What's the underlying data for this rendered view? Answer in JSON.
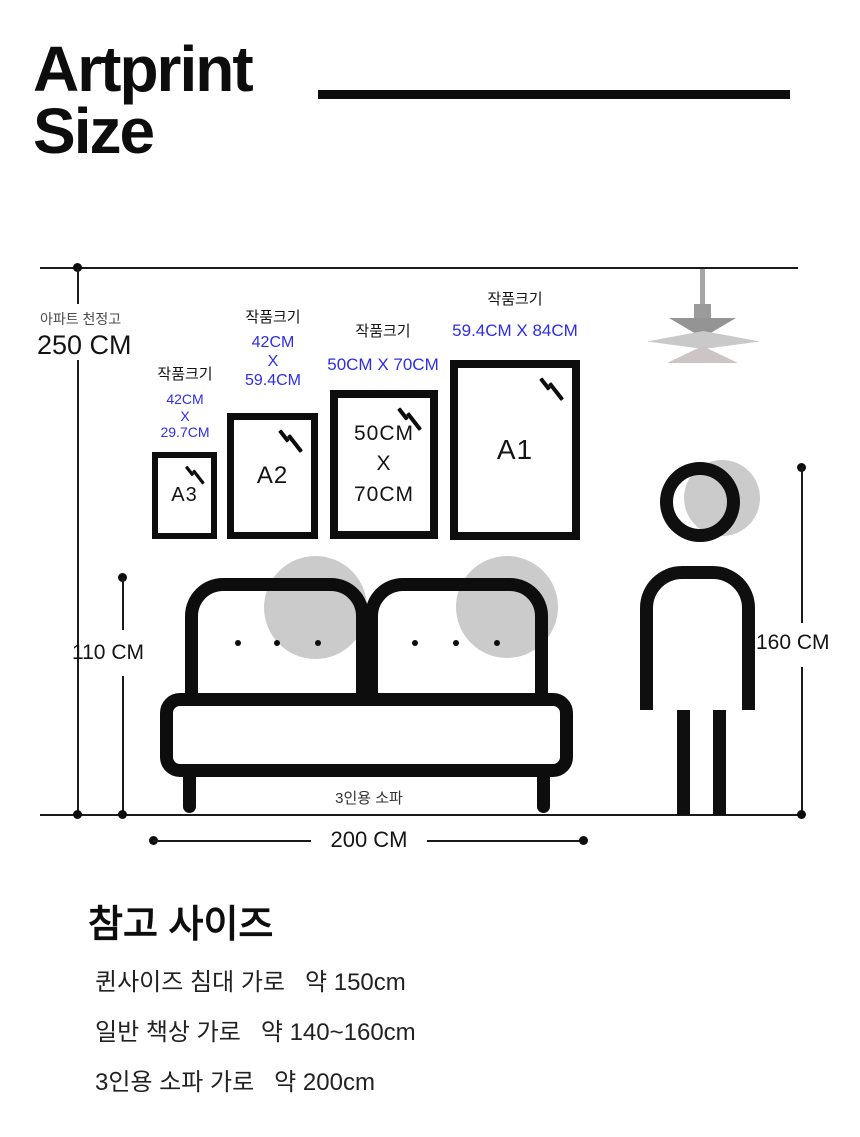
{
  "title": {
    "text": "Artprint\nSize"
  },
  "colors": {
    "accent_blue": "#2e2ee9",
    "ink": "#0d0d0d",
    "shape_gray": "#cbcbcb"
  },
  "icons": [
    "pendant-lamp-icon",
    "glass-glare-icon",
    "sofa-figure",
    "person-figure"
  ],
  "diagram": {
    "ceiling": {
      "caption": "아파트 천정고",
      "value": "250 CM"
    },
    "frames": [
      {
        "caption": "작품크기",
        "dims": [
          "42CM",
          "X",
          "29.7CM"
        ],
        "inner": "A3"
      },
      {
        "caption": "작품크기",
        "dims": [
          "42CM",
          "X",
          "59.4CM"
        ],
        "inner": "A2"
      },
      {
        "caption": "작품크기",
        "dims": [
          "50CM X 70CM"
        ],
        "inner_lines": [
          "50CM",
          "X",
          "70CM"
        ]
      },
      {
        "caption": "작품크기",
        "dims": [
          "59.4CM X 84CM"
        ],
        "inner": "A1"
      }
    ],
    "sofa": {
      "label": "3인용 소파",
      "height": "110 CM",
      "width": "200 CM"
    },
    "person": {
      "height": "160 CM"
    }
  },
  "reference": {
    "heading": "참고 사이즈",
    "items": [
      "퀸사이즈 침대 가로   약 150cm",
      "일반 책상 가로   약 140~160cm",
      "3인용 소파 가로   약 200cm"
    ]
  }
}
